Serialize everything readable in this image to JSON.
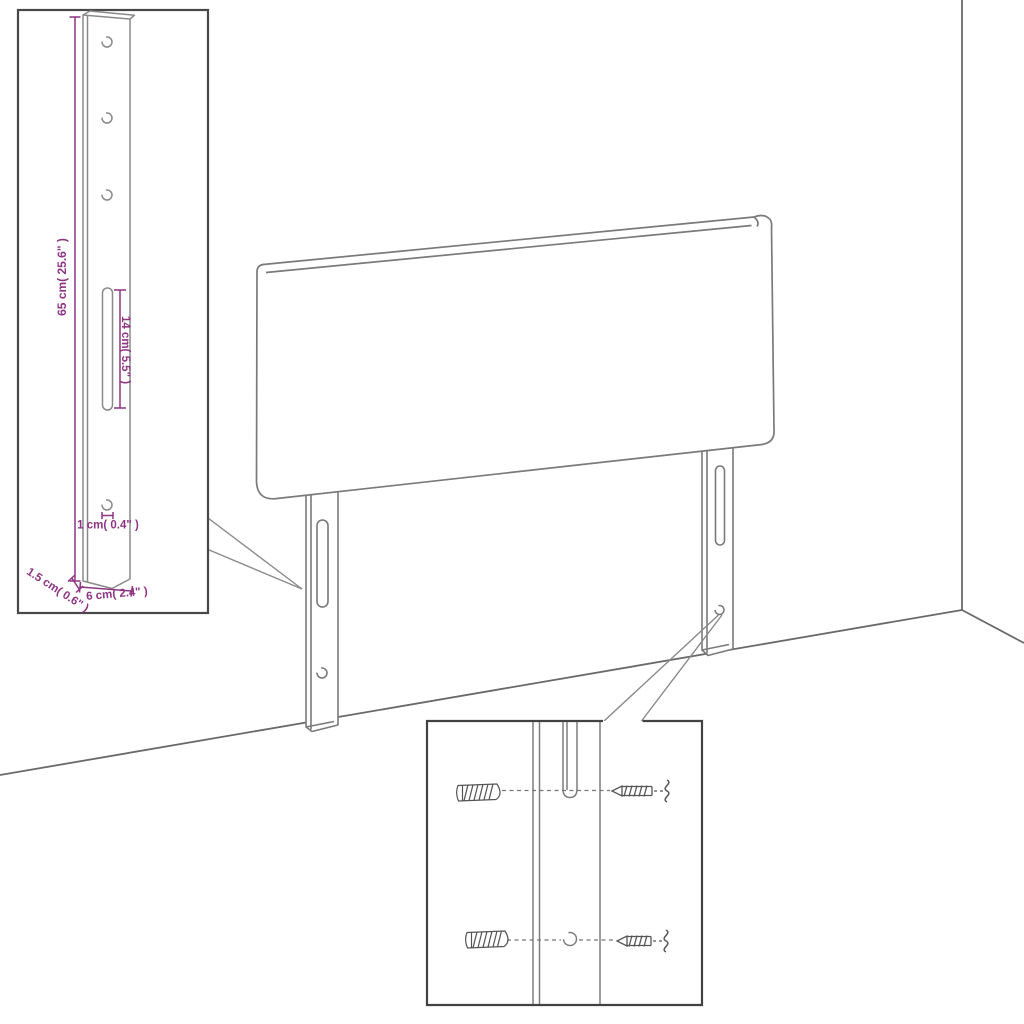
{
  "page": {
    "background": "#ffffff",
    "description": "Assembly diagram of an upholstered headboard with two slotted wall-mount legs, a dimensioned leg detail inset (top-left) and a wall-anchor/screw mounting detail inset (bottom-center)"
  },
  "colors": {
    "outline": "#7a7a7a",
    "wall_line": "#696969",
    "inset_border": "#484848",
    "dimension": "#8e3482",
    "hardware": "#555555",
    "background": "#ffffff"
  },
  "main_view": {
    "parts": [
      "headboard-panel",
      "left-mounting-leg",
      "right-mounting-leg",
      "wall-corner",
      "floor-line"
    ],
    "left_leg_features": [
      "mounting-slot",
      "screw-hole"
    ],
    "right_leg_features": [
      "mounting-slot",
      "screw-hole"
    ]
  },
  "leg_detail_inset": {
    "features": [
      "screw-hole-top",
      "screw-hole-upper",
      "screw-hole-middle",
      "mounting-slot",
      "screw-hole-bottom"
    ],
    "dimensions": {
      "leg_height": "65 cm( 25.6\" )",
      "slot_length": "14 cm( 5.5\" )",
      "hole_diameter": "1 cm( 0.4\" )",
      "leg_thickness": "1.5 cm( 0.6\" )",
      "leg_width": "6 cm( 2.4\" )"
    }
  },
  "mounting_detail_inset": {
    "rows": [
      {
        "items": [
          "wall-anchor",
          "mounting-slot",
          "screw"
        ]
      },
      {
        "items": [
          "wall-anchor",
          "screw-hole",
          "screw"
        ]
      }
    ]
  }
}
